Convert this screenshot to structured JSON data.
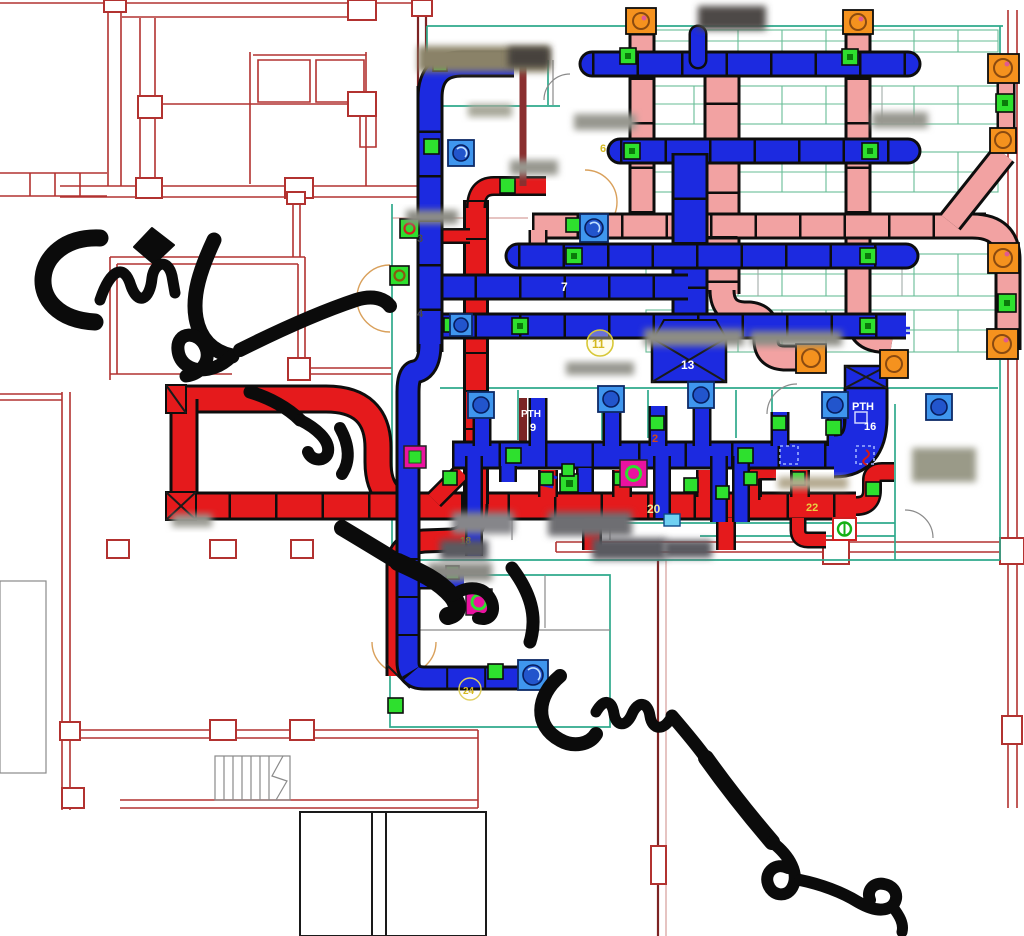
{
  "watermark": {
    "text": "مهندس امير سلماني"
  },
  "colors": {
    "supply_duct_blue": "#1c2ae0",
    "exhaust_duct_red": "#e51a1c",
    "return_duct_pink": "#f2a2a2",
    "diffuser_green": "#2ee02e",
    "fire_damper_orange": "#f5921e",
    "damper_magenta": "#ea12a0",
    "plan_wall_red": "#b23230",
    "zone_line_teal": "#2fa98c"
  },
  "labels": {
    "n2": {
      "text": "2"
    },
    "n3": {
      "text": "3"
    },
    "n4": {
      "text": "4"
    },
    "n6": {
      "text": "6"
    },
    "n7": {
      "text": "7"
    },
    "n9": {
      "text": "9"
    },
    "n11": {
      "text": "11"
    },
    "n13": {
      "text": "13"
    },
    "n16": {
      "text": "16"
    },
    "n18": {
      "text": "18"
    },
    "n20": {
      "text": "20"
    },
    "n22": {
      "text": "22"
    },
    "n24": {
      "text": "24"
    },
    "pth_a": {
      "text": "PTH"
    },
    "pth_b": {
      "text": "PTH"
    }
  }
}
